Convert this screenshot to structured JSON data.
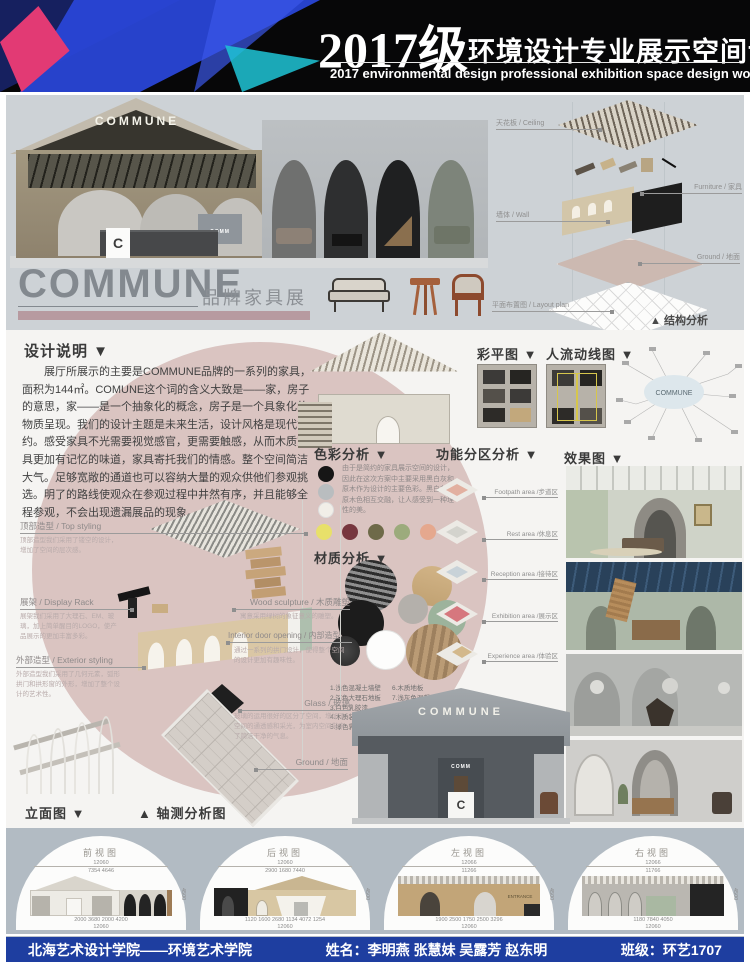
{
  "header": {
    "year": "2017级",
    "title": "环境设计专业展示空间设计作品展",
    "subtitle": "2017 environmental design professional exhibition space design works exhibition"
  },
  "hero": {
    "sign": "COMMUNE",
    "sign_sub": "COMM",
    "logo": "C"
  },
  "exploded": {
    "labels": {
      "ceiling": "天花板 / Ceiling",
      "furniture": "Furniture / 家具",
      "wall": "墙体 / Wall",
      "ground": "Ground / 地面",
      "layout": "平面布置图 / Layout plan"
    },
    "caption": "▲ 结构分析"
  },
  "brand": {
    "name": "COMMUNE",
    "tag": "品牌家具展"
  },
  "design_note": {
    "heading": "设计说明 ▼",
    "body": "展厅所展示的主要是COMMUNE品牌的一系列的家具，面积为144㎡。COMUNE这个词的含义大致是——家，房子的意思，家——是一个抽象化的概念，房子是一个具象化的物质呈现。我们的设计主题是未来生活，设计风格是现代简约。感受家具不光需要视觉感官，更需要触感，从而木质家具更加有记忆的味道，家具寄托我们的情感。整个空间简洁大气。足够宽敞的通道也可以容纳大量的观众供他们参观挑选。明了的路线使观众在参观过程中井然有序，并且能够全程参观，不会出现遗漏展品的现象。"
  },
  "plans": {
    "color_plan": "彩平图 ▼",
    "flow": "人流动线图 ▼",
    "mindmap_center": "COMMUNE"
  },
  "color_analysis": {
    "heading": "色彩分析 ▼",
    "desc": "由于是简约的家具展示空间的设计，因此在这次方案中主要采用黑白灰和原木作为设计的主要色彩。黑白灰与原木色相互交融，让人感受到一种理性的美。",
    "primary": [
      "#161616",
      "#b9bdbf",
      "#f1eee8"
    ],
    "accents": [
      "#e8e06a",
      "#77373f",
      "#6e6a49",
      "#9cab7c",
      "#e5a88e",
      "#a98a6d"
    ]
  },
  "zoning": {
    "heading": "功能分区分析 ▼",
    "zones": [
      "Footpath area /步道区",
      "Rest area /休息区",
      "Reception area /接待区",
      "Exhibition area /展示区",
      "Experience area /体验区"
    ]
  },
  "renders": {
    "heading": "效果图 ▼"
  },
  "materials": {
    "heading": "材质分析 ▼",
    "legend": [
      "1.浅色混凝土墙壁",
      "2.深色大理石地板",
      "3.白色乳胶漆",
      "4.木质装饰面",
      "5.绿色乳胶漆",
      "6.木质地板",
      "7.浅灰色混凝土",
      "8.钢结构",
      "9.皮革装饰面",
      "10.硬包装饰面"
    ]
  },
  "axon": {
    "top_styling": {
      "title": "顶部造型 / Top styling",
      "desc": "顶部造型我们采用了镂空的设计，增加了空间的层次感。"
    },
    "display_rack": {
      "title": "展架 / Display Rack",
      "desc": "展架我们采用了大理石、EM、玻璃，加上简单醒目的LOGO，使产品展示的更加丰富多彩。"
    },
    "exterior": {
      "title": "外部造型 / Exterior styling",
      "desc": "外部造型我们采用了几何元素，弧形拱门和拱形窗的外形，增加了整个设计的艺术性。"
    },
    "wood_sculpture": {
      "title": "Wood sculpture / 木质雕塑",
      "desc": "寓意采用绿树的象征意义的雕塑。"
    },
    "door": {
      "title": "Interior door opening / 内部造型",
      "desc": "通过一系列的拱门设计，使得整个空间的设计更加有趣味性。"
    },
    "glass": {
      "title": "Glass / 玻璃",
      "desc": "玻璃的运用很好的区分了空间，增加了空间的通透感和采光，为室内空间带来了简洁干净的气息。"
    },
    "ground": "Ground / 地面",
    "elevation_caption": "立面图 ▼",
    "axon_caption": "▲ 轴测分析图"
  },
  "elevations": {
    "views": [
      {
        "title": "前视图",
        "top_dim": "12060",
        "mid_dims": "7354    4646",
        "bottom_dims": "2000   3680   2000   4200",
        "total": "12060",
        "side": "4500"
      },
      {
        "title": "后视图",
        "top_dim": "12060",
        "mid_dims": "2900   1680   7440",
        "bottom_dims": "1120 1600 2680 1134 4072 1254",
        "total": "12060",
        "side": "4500"
      },
      {
        "title": "左视图",
        "top_dim": "12066",
        "mid_dims": "11266",
        "bottom_dims": "1900   2500   1750   2500   3296",
        "total": "12060",
        "side": "4500",
        "note": "ENTRANCE"
      },
      {
        "title": "右视图",
        "top_dim": "12066",
        "mid_dims": "11766",
        "bottom_dims": "1180   7840   4050",
        "total": "12060",
        "side": "4500"
      }
    ]
  },
  "footer": {
    "school": "北海艺术设计学院——环境艺术学院",
    "names": "姓名：李明燕 张慧妹 吴露芳 赵东明",
    "class": "班级：环艺1707"
  }
}
